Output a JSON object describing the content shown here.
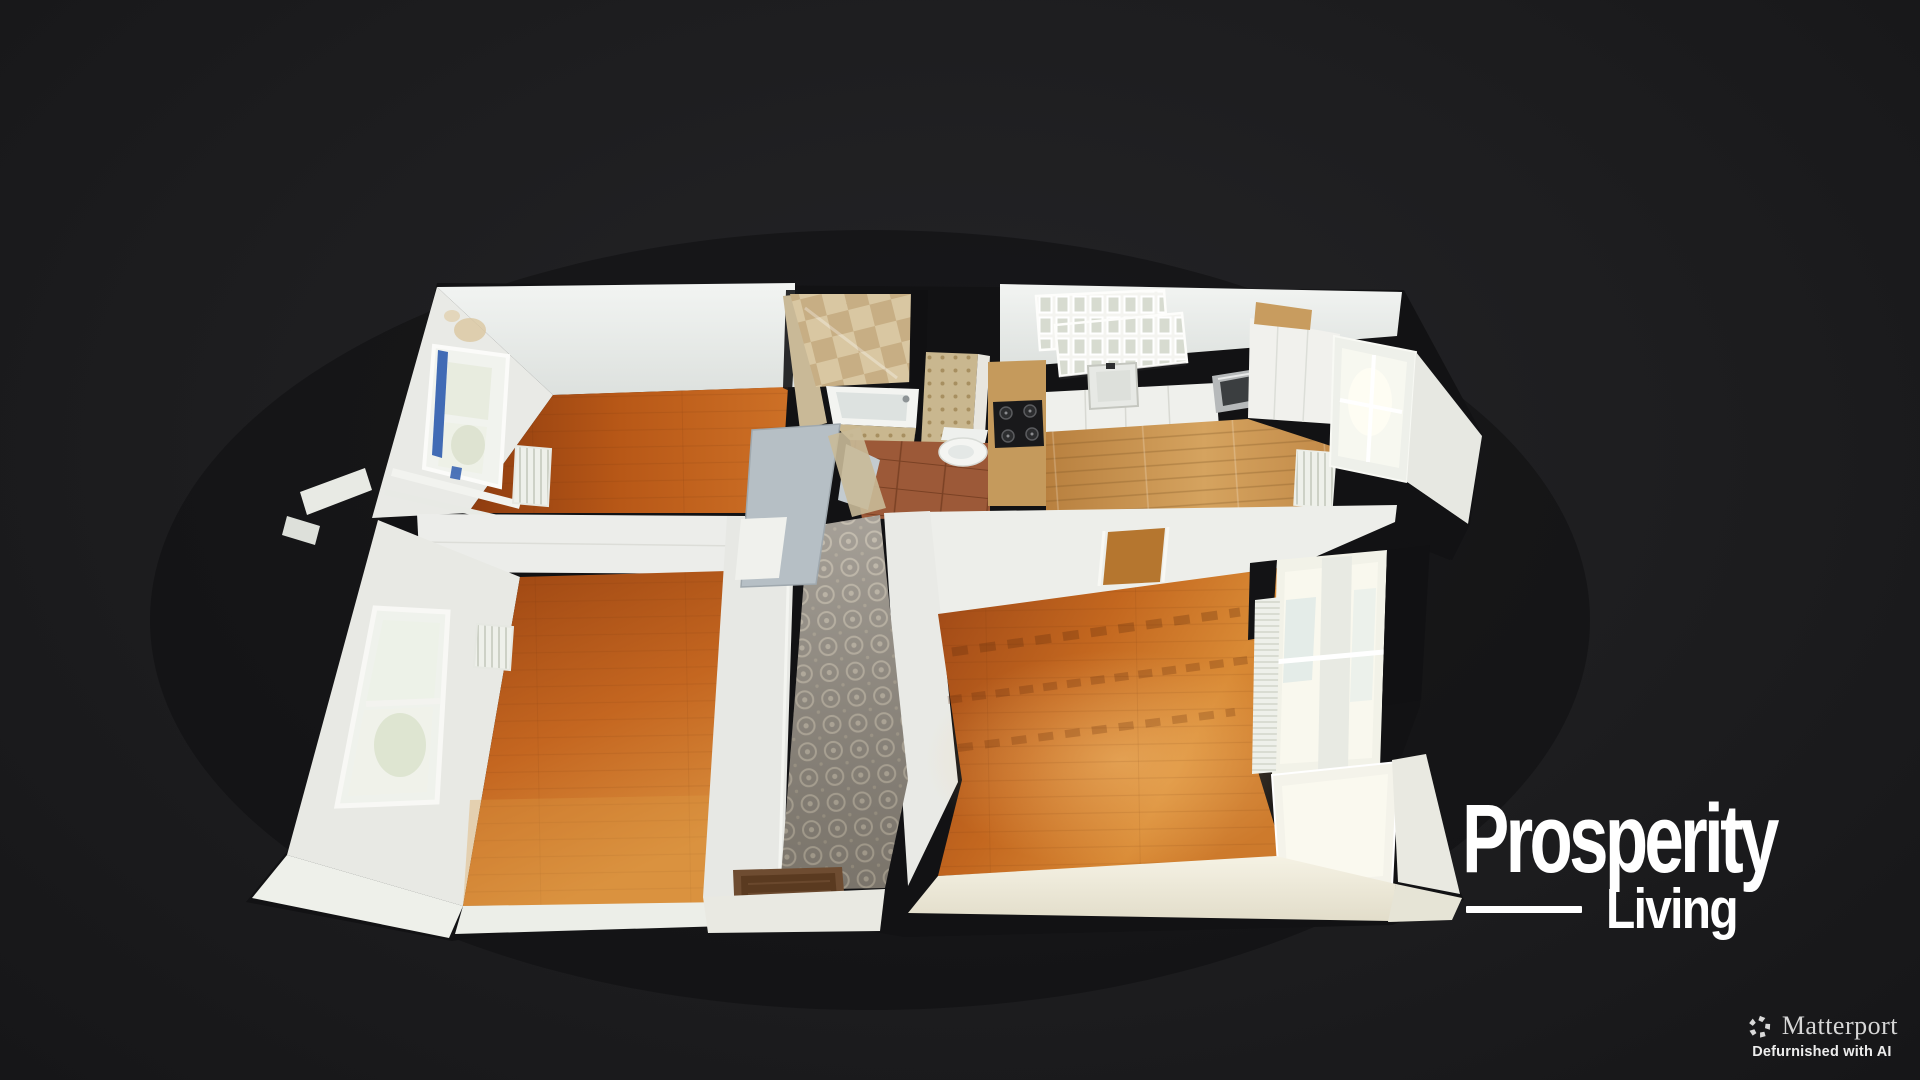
{
  "app": {
    "background_color": "#1c1c1e",
    "view": "3D dollhouse top-down floor plan"
  },
  "branding": {
    "line1": "Prosperity",
    "line2": "Living",
    "color": "#ffffff"
  },
  "attribution": {
    "brand": "Matterport",
    "tagline": "Defurnished with AI",
    "icon": "matterport-pinwheel-icon",
    "brand_color": "#d6d6d6",
    "tagline_color": "#ededed"
  },
  "floorplan": {
    "rooms": [
      "bedroom-top-left",
      "bathroom",
      "wc",
      "kitchen",
      "bedroom-bottom-left",
      "hallway",
      "living-room"
    ],
    "colors": {
      "wall_white": "#eceee9",
      "wood_dark": "#8e3c0f",
      "wood_mid": "#b85817",
      "wood_light": "#cd7026",
      "kitchen_oak": "#d5a35f",
      "hall_tile": "#8e877c",
      "bath_tile_light": "#d9c7a2",
      "bath_tile_dark": "#c7ae84",
      "terracotta": "#9c5938",
      "window_blue": "#2e5cae"
    }
  }
}
